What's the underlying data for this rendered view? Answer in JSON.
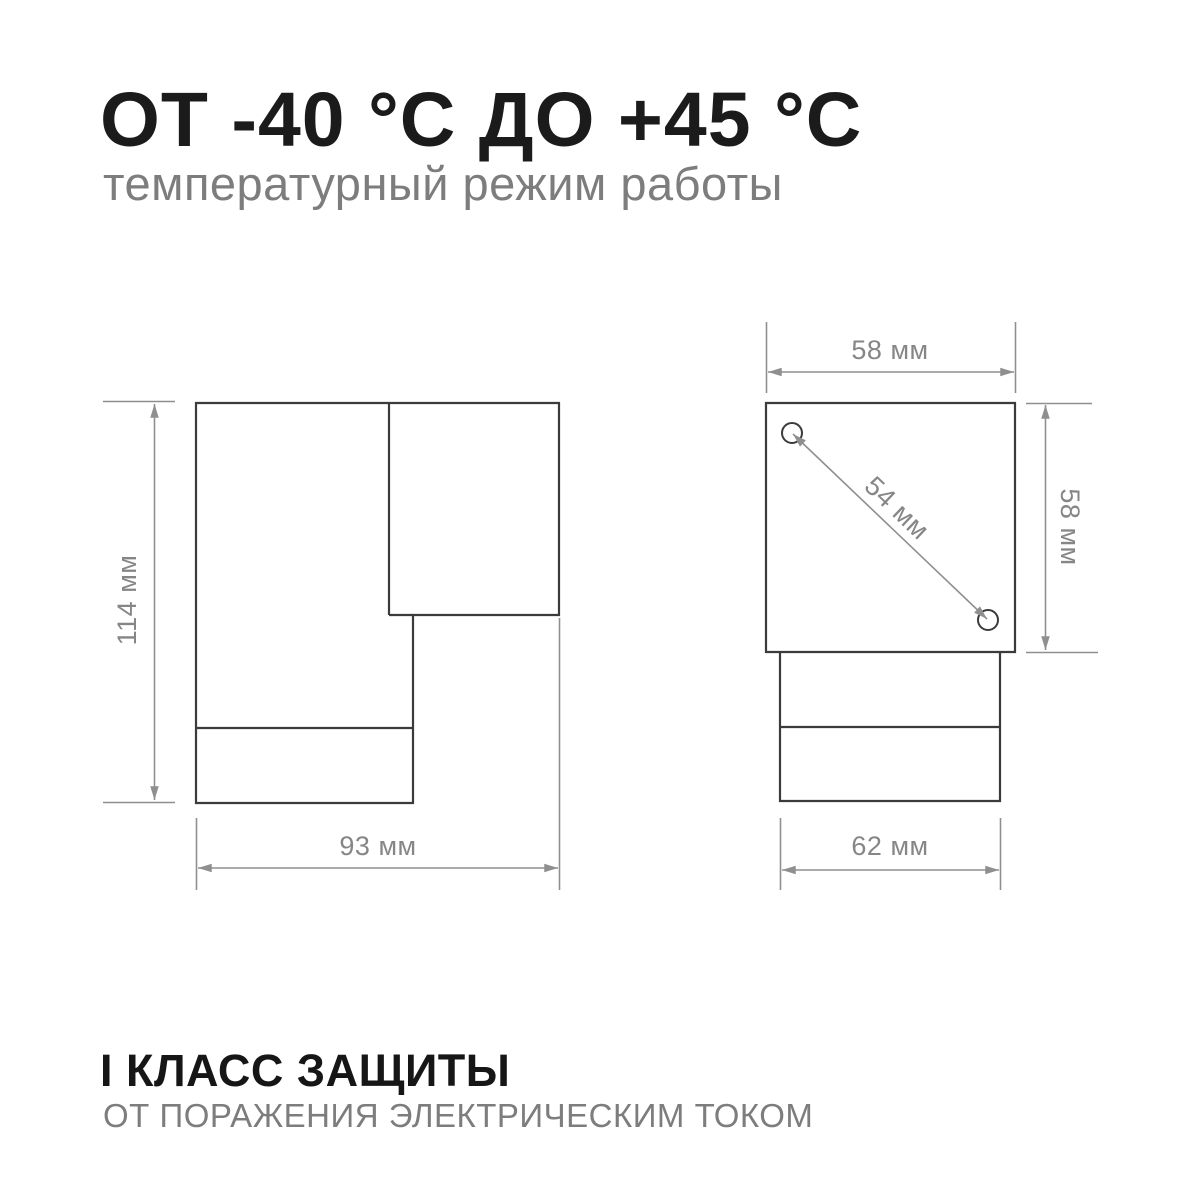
{
  "header": {
    "title": "ОТ -40 °С ДО +45 °С",
    "subtitle": "температурный режим работы"
  },
  "diagrams": {
    "side_view": {
      "height_label": "114 мм",
      "width_label": "93 мм"
    },
    "top_view": {
      "width_label": "58 мм",
      "height_label": "58 мм",
      "diagonal_label": "54 мм",
      "base_width_label": "62 мм"
    }
  },
  "footer": {
    "title": "I КЛАСС ЗАЩИТЫ",
    "subtitle": "ОТ ПОРАЖЕНИЯ ЭЛЕКТРИЧЕСКИМ ТОКОМ"
  },
  "colors": {
    "outline": "#3b3b3b",
    "dimension": "#8f8f8f",
    "dimension_text": "#868686",
    "title_text": "#1b1b1b",
    "subtitle_text": "#7d7d7d",
    "background": "#ffffff"
  }
}
